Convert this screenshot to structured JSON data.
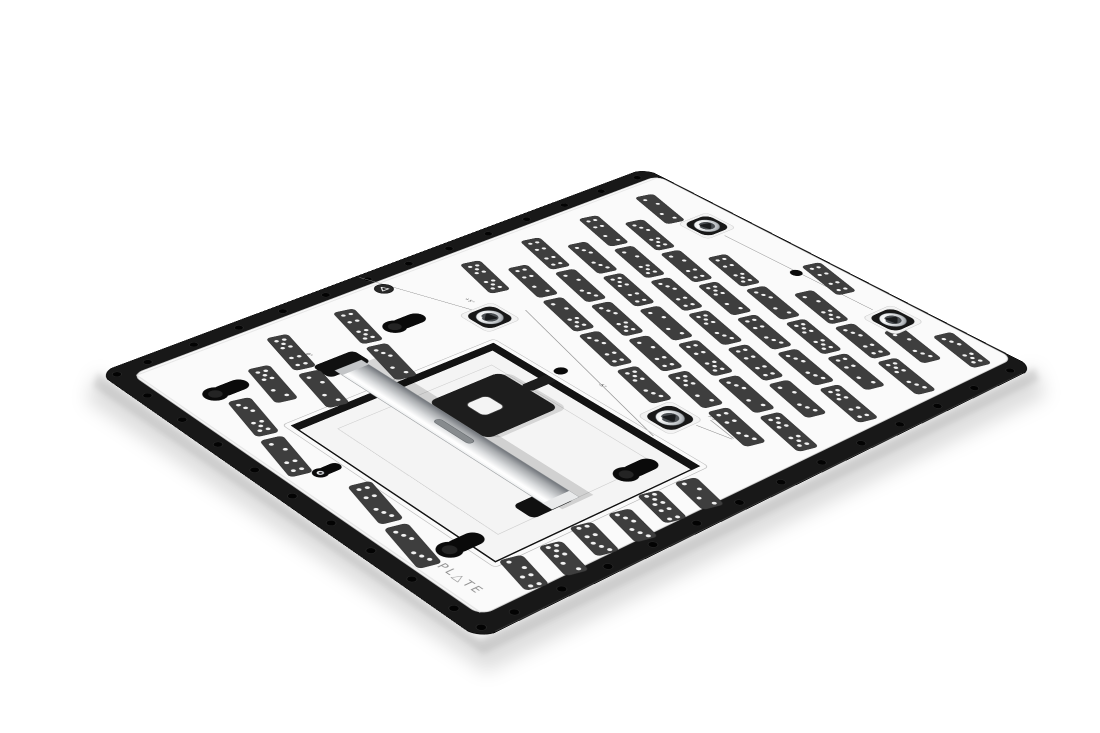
{
  "meta": {
    "description": "Product photo of a black and white calibration fixture plate with domino test targets, viewed at an angle on a white studio background"
  },
  "scene": {
    "width": 1100,
    "height": 733,
    "background": "#ffffff",
    "homography": [
      0.81378,
      -0.22238,
      0.0002016,
      0.53447,
      0.30875,
      -0.0002129,
      98,
      373,
      1
    ],
    "shadow": {
      "color_soft": "rgba(0,0,0,0.13)",
      "color_core": "rgba(0,0,0,0.10)",
      "path_soft": "M98,373 L480,640 L1035,368 L1046,396 L486,672 L86,400 Z",
      "path_core": "M98,373 L480,640 L1035,368 L1039,380 L483,654 L93,386 Z",
      "blur_soft": 9,
      "blur_core": 3
    }
  },
  "plate": {
    "local_width": 800,
    "local_height": 600,
    "corner_radius": 22,
    "colors": {
      "base": "#181818",
      "base_outline": "#050505",
      "base_arris": "#3d3d3d",
      "hole": "#030303",
      "hole_rim": "#2e2e2e",
      "top": "#fafafa",
      "top_edge": "#cfcfcf",
      "top_inner_shadow": "#e4e4e4"
    },
    "top_rect": {
      "x": 26,
      "y": 24,
      "w": 771,
      "h": 548,
      "r": 14
    },
    "notch": {
      "x": -7,
      "y": 452,
      "w": 14,
      "h": 64,
      "r": 4
    },
    "band_holes": {
      "radius": 4.8,
      "top": {
        "y": 13,
        "x_start": 54,
        "x_end": 774,
        "step": 60
      },
      "left": {
        "x": 14,
        "y_start": 68,
        "y_end": 548,
        "step": 60
      },
      "bottom": {
        "y": 587,
        "x_start": 54,
        "x_end": 774,
        "step": 60
      },
      "corners": [
        [
          14,
          14
        ],
        [
          14,
          586
        ]
      ]
    }
  },
  "recess": {
    "chamfer": {
      "x": 88,
      "y": 198,
      "w": 289,
      "h": 324,
      "r": 5,
      "stroke": "#bdbdbd"
    },
    "floor": {
      "x": 95,
      "y": 205,
      "w": 275,
      "h": 310,
      "fill": "#f4f4f4",
      "stroke": "#c9c9c9"
    },
    "inner_step": {
      "x": 128,
      "y": 238,
      "w": 210,
      "h": 244,
      "stroke": "#d2d2d2"
    },
    "frame_color": "#131313",
    "band_top": {
      "x": 95,
      "y": 205,
      "w": 275,
      "h": 11
    },
    "band_right": {
      "x": 359,
      "y": 205,
      "w": 11,
      "h": 310
    }
  },
  "rail": {
    "x": 199,
    "y": 146,
    "w": 36,
    "h": 336,
    "cap_color": "#c3c5c7",
    "foot_color": "#e9eaeb",
    "edge_color": "#85898c",
    "slot": {
      "x": 214,
      "y": 286,
      "w": 9,
      "h": 56,
      "r": 4.5,
      "fill": "#878b8e",
      "stroke": "#62666a"
    },
    "shadow_opacity": 0.14,
    "gradient": [
      [
        0,
        "#eef0f1"
      ],
      [
        0.18,
        "#ffffff"
      ],
      [
        0.45,
        "#d9dbdd"
      ],
      [
        0.75,
        "#a8abae"
      ],
      [
        1,
        "#70747a"
      ]
    ]
  },
  "clamp_tabs": [
    {
      "x": 185,
      "y": 125,
      "w": 56,
      "h": 30,
      "r": 7
    },
    {
      "x": 173,
      "y": 453,
      "w": 56,
      "h": 30,
      "r": 7
    }
  ],
  "bracket": {
    "body": {
      "x": 235,
      "y": 254,
      "w": 100,
      "h": 92,
      "r": 10
    },
    "arm": {
      "x": 335,
      "y": 288,
      "w": 36,
      "h": 16,
      "r": 3
    },
    "color": "#1d1d1d",
    "hole": {
      "x": 262,
      "y": 281,
      "w": 30,
      "h": 30,
      "r": 7,
      "fill": "#f4f4f4",
      "stroke": "#4e4e4e"
    }
  },
  "inserts": {
    "positions": [
      [
        405,
        160
      ],
      [
        752,
        152
      ],
      [
        757,
        435
      ],
      [
        413,
        431
      ]
    ],
    "cam_rotations": [
      18,
      75,
      200,
      320
    ],
    "pad_fill": "#f3f3f3",
    "pad_stroke": "#d2d2d2",
    "recess_fill": "#181818",
    "ring_stroke": "#5f6468",
    "bore_fill": "#4a4e52",
    "cam_fill": "#191b1d",
    "metal_gradient": [
      [
        0,
        "#ffffff"
      ],
      [
        0.45,
        "#e8eaec"
      ],
      [
        0.75,
        "#b9bdc1"
      ],
      [
        1,
        "#777b80"
      ]
    ]
  },
  "cutouts": {
    "color": "#0a0a0a",
    "wall_color": "#242424",
    "large": [
      [
        322,
        113
      ],
      [
        84,
        108
      ],
      [
        314,
        481
      ],
      [
        87,
        473
      ]
    ],
    "small": [
      [
        70,
        292
      ]
    ],
    "pill_hole": {
      "x": 388,
      "y": 292,
      "rx": 8,
      "ry": 7
    },
    "round_hole": {
      "x": 751,
      "y": 295,
      "r": 7.2
    }
  },
  "badge": {
    "x": 354,
    "y": 41,
    "r": 10.5,
    "ring": "#282828",
    "rim": "#101010",
    "glyph": "#ececec"
  },
  "logo": {
    "text": "PL△TE",
    "x": 46,
    "y": 486,
    "size": 14,
    "letter_spacing": 3,
    "color": "#8e8e8e"
  },
  "angle_labels": [
    {
      "text": "0°",
      "x": 196,
      "y": 100
    },
    {
      "text": "+5°",
      "x": 410,
      "y": 112
    },
    {
      "text": "-5°",
      "x": 400,
      "y": 336
    },
    {
      "text": "-10°",
      "x": 130,
      "y": 138
    },
    {
      "text": "7.5°",
      "x": 446,
      "y": 452
    }
  ],
  "label_style": {
    "size": 6.5,
    "color": "#4a4a4a"
  },
  "scribe_lines": [
    {
      "x1": 349,
      "y1": 4,
      "x2": 402,
      "y2": 140
    },
    {
      "x1": 447,
      "y1": 172,
      "x2": 374,
      "y2": 446
    },
    {
      "x1": 751,
      "y1": 182,
      "x2": 756,
      "y2": 406
    },
    {
      "x1": 424,
      "y1": 458,
      "x2": 434,
      "y2": 500
    },
    {
      "x1": 443,
      "y1": 460,
      "x2": 436,
      "y2": 500
    }
  ],
  "scribe_style": {
    "color": "#8a8a8a",
    "width": 0.9
  },
  "dominoes": {
    "fill": "#3e3e3e",
    "stroke": "#2a2a2a",
    "pip_color": "#f2f2f2",
    "pip_radius": 2.5,
    "width": 25,
    "length": 74,
    "extra_length": 54,
    "tilt_deg": 14,
    "cols_x0": 48,
    "cols_dx": 46,
    "cols_n": 20,
    "rows_y0": 88,
    "rows_dt": 82,
    "rows_n": 6,
    "stagger": 41,
    "x_min": 40,
    "x_max": 772,
    "y_min": 66,
    "y_max": 528,
    "pip_patterns": [
      [
        3,
        5
      ],
      [
        2,
        4
      ],
      [
        5,
        2
      ],
      [
        4,
        3
      ],
      [
        3,
        3
      ],
      [
        5,
        4
      ],
      [
        2,
        2
      ],
      [
        4,
        5
      ],
      [
        3,
        2
      ],
      [
        5,
        5
      ],
      [
        4,
        2
      ],
      [
        2,
        5
      ],
      [
        3,
        4
      ],
      [
        5,
        3
      ],
      [
        4,
        4
      ],
      [
        2,
        3
      ]
    ],
    "pip_layout": {
      "1": [
        [
          0,
          0
        ]
      ],
      "2": [
        [
          -4.5,
          -7
        ],
        [
          4.5,
          7
        ]
      ],
      "3": [
        [
          -4.5,
          -8
        ],
        [
          0,
          0
        ],
        [
          4.5,
          8
        ]
      ],
      "4": [
        [
          -4.5,
          -8
        ],
        [
          4.5,
          -8
        ],
        [
          -4.5,
          8
        ],
        [
          4.5,
          8
        ]
      ],
      "5": [
        [
          -4.5,
          -8
        ],
        [
          4.5,
          -8
        ],
        [
          0,
          0
        ],
        [
          -4.5,
          8
        ],
        [
          4.5,
          8
        ]
      ]
    },
    "skip_rects": [
      {
        "x1": 72,
        "y1": 184,
        "x2": 402,
        "y2": 536
      },
      {
        "x1": 330,
        "y1": 0,
        "x2": 430,
        "y2": 184
      },
      {
        "x1": 398,
        "y1": 184,
        "x2": 452,
        "y2": 300
      },
      {
        "x1": 375,
        "y1": 300,
        "x2": 430,
        "y2": 460
      }
    ],
    "skip_points": [
      {
        "x": 322,
        "y": 113,
        "r": 44
      },
      {
        "x": 84,
        "y": 108,
        "r": 44
      },
      {
        "x": 314,
        "y": 481,
        "r": 44
      },
      {
        "x": 87,
        "y": 473,
        "r": 44
      },
      {
        "x": 70,
        "y": 292,
        "r": 38
      },
      {
        "x": 405,
        "y": 160,
        "r": 56
      },
      {
        "x": 752,
        "y": 152,
        "r": 56
      },
      {
        "x": 757,
        "y": 435,
        "r": 56
      },
      {
        "x": 413,
        "y": 431,
        "r": 56
      },
      {
        "x": 751,
        "y": 295,
        "r": 36
      },
      {
        "x": 388,
        "y": 292,
        "r": 36
      },
      {
        "x": 354,
        "y": 41,
        "r": 34
      },
      {
        "x": 213,
        "y": 140,
        "r": 40
      },
      {
        "x": 201,
        "y": 468,
        "r": 40
      },
      {
        "x": 55,
        "y": 525,
        "r": 46
      }
    ],
    "extra": [
      {
        "x": 104,
        "y": 545
      },
      {
        "x": 150,
        "y": 551
      },
      {
        "x": 196,
        "y": 545
      },
      {
        "x": 242,
        "y": 551
      },
      {
        "x": 288,
        "y": 545
      },
      {
        "x": 334,
        "y": 551
      }
    ]
  }
}
